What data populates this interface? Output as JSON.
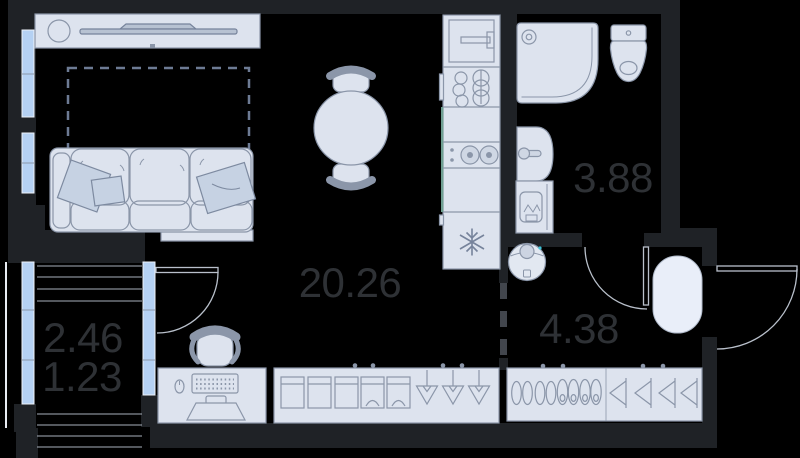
{
  "plan": {
    "title": "studio-apartment-floor-plan",
    "rooms": {
      "living_kitchen": {
        "area": "20.26"
      },
      "bathroom": {
        "area": "3.88"
      },
      "hallway": {
        "area": "4.38"
      },
      "balcony": {
        "area_total": "2.46",
        "area_reduced": "1.23"
      }
    },
    "palette": {
      "background": "#000000",
      "wall": "#1f2226",
      "furniture_fill": "#dde3ee",
      "furniture_line": "#8b96a9",
      "pillow_fill": "#c6d2e3",
      "window_glass": "#b5d1f3",
      "window_frame": "#eef2f9",
      "door_arc": "#b9c0cb",
      "hatch_line": "#a9b0bb",
      "label_text": "#2e3135",
      "rug_fill": "#e9eef9",
      "vacuum_accent": "#3fc3d8",
      "counter_accent": "#6f9f92"
    },
    "symbols": [
      "tv-console",
      "sofa",
      "bed-zone-dashed",
      "dining-table",
      "dining-chairs",
      "oven",
      "dish-rack",
      "cooktop",
      "fridge-snowflake",
      "shower",
      "toilet",
      "sink",
      "washing-machine",
      "robot-vacuum",
      "entry-rug",
      "desk-with-computer",
      "office-chair",
      "wardrobe-boxes",
      "wardrobe-hangers",
      "shoe-rack",
      "coat-hangers",
      "balcony-glazing",
      "entry-door-swing",
      "bathroom-door-swing",
      "balcony-door-swing"
    ]
  }
}
